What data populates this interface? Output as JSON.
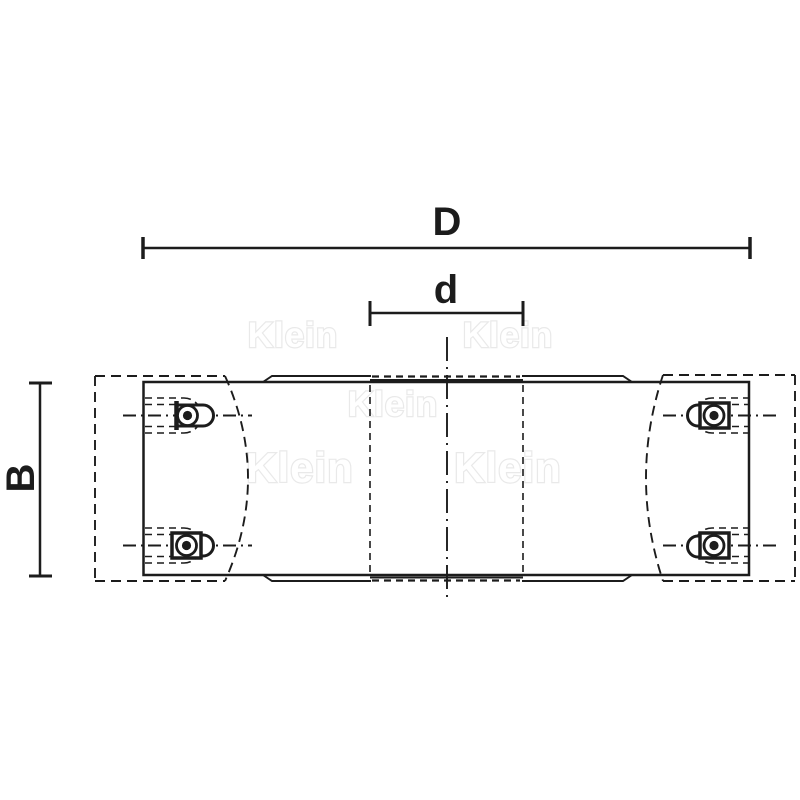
{
  "drawing": {
    "type": "technical-drawing",
    "subject": "cutterhead-side-view",
    "dimensions": {
      "outer_diameter_label": "D",
      "bore_diameter_label": "d",
      "body_width_label": "B"
    },
    "watermark": {
      "text": "Klein",
      "color": "#e9e9e9"
    },
    "colors": {
      "line": "#1c1c1c",
      "background": "#ffffff"
    }
  }
}
